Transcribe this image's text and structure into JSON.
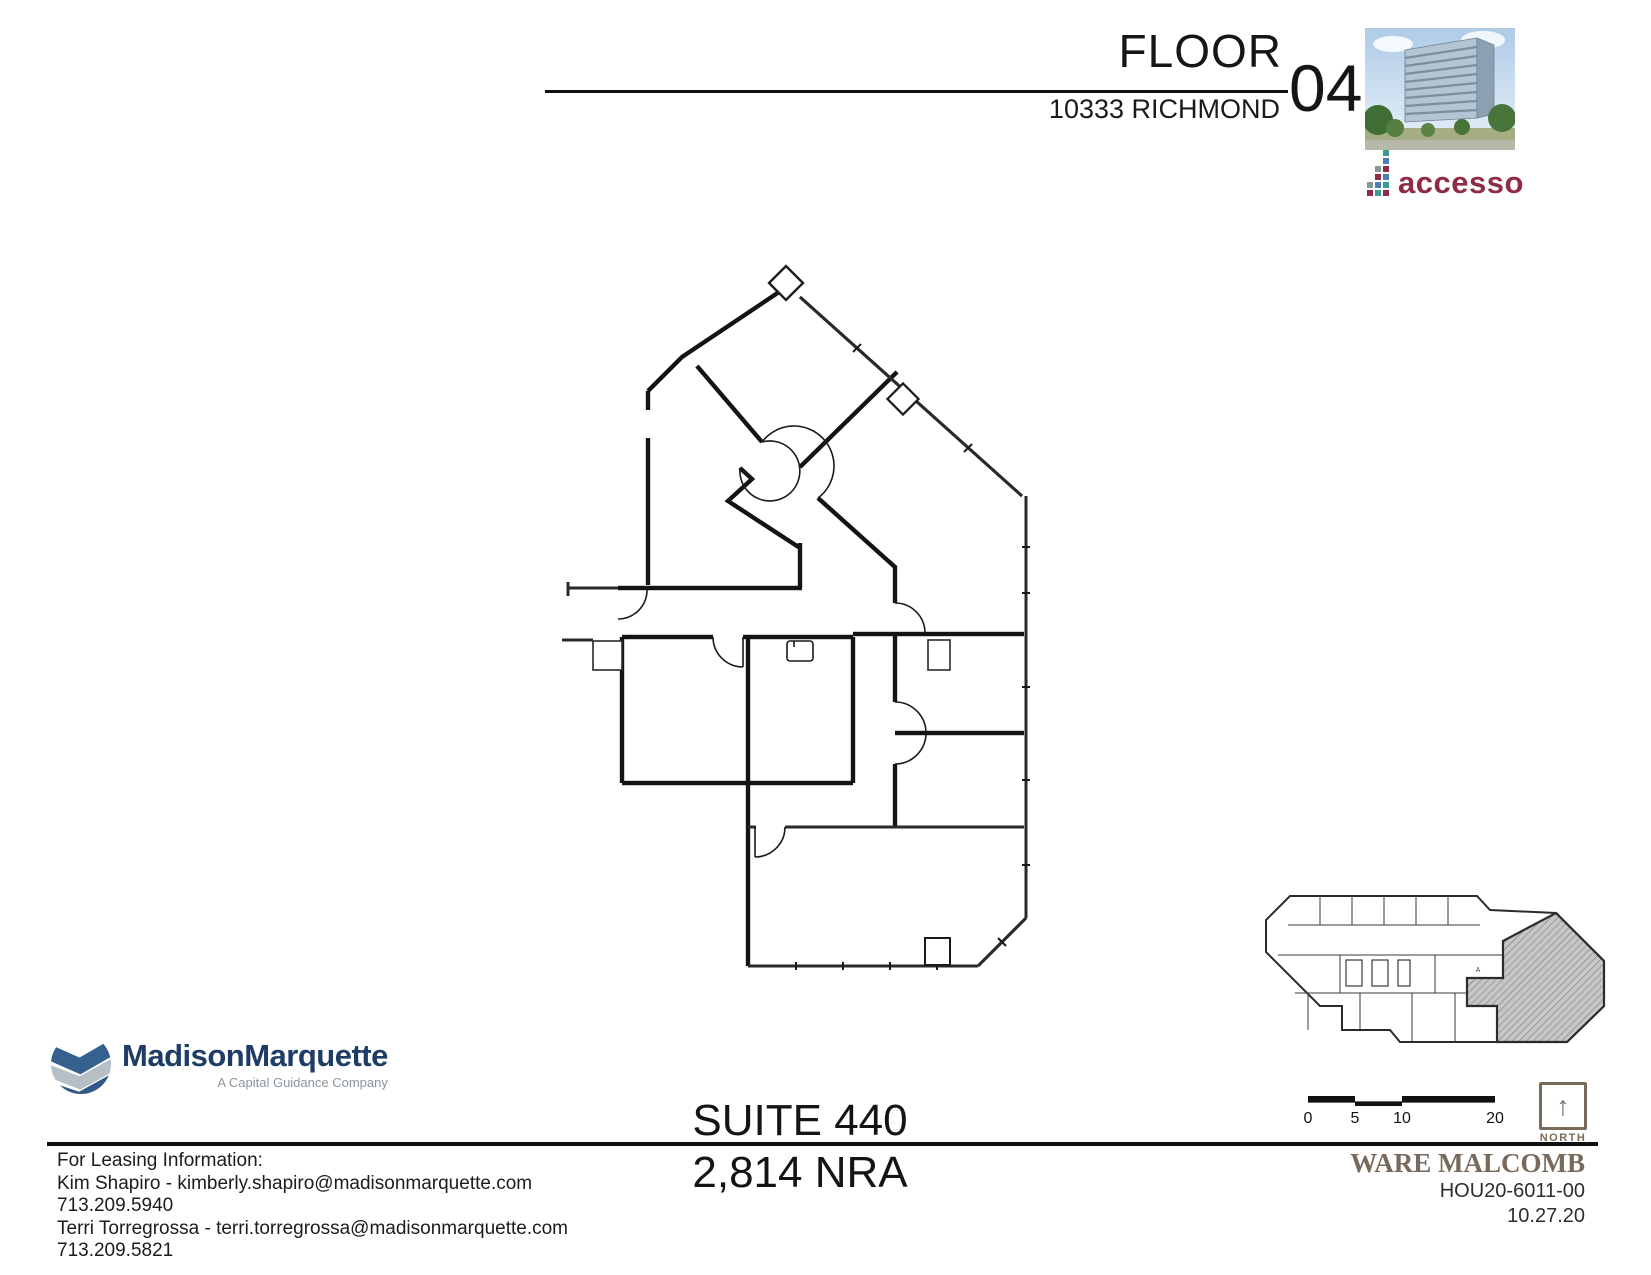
{
  "header": {
    "title": "FLOOR",
    "floor_number": "04",
    "address": "10333 RICHMOND"
  },
  "suite": {
    "name": "SUITE 440",
    "area": "2,814 NRA"
  },
  "leasing": {
    "heading": "For Leasing Information:",
    "lines": [
      "Kim Shapiro - kimberly.shapiro@madisonmarquette.com",
      "713.209.5940",
      "Terri Torregrossa - terri.torregrossa@madisonmarquette.com",
      "713.209.5821"
    ]
  },
  "branding": {
    "accesso": {
      "name": "accesso",
      "text_color": "#8f2b45"
    },
    "madison": {
      "name": "MadisonMarquette",
      "tagline": "A Capital Guidance Company",
      "navy": "#1d3c66"
    },
    "ware_malcomb": {
      "name": "WARE MALCOMB",
      "project_number": "HOU20-6011-00",
      "date": "10.27.20",
      "color": "#776a5c"
    }
  },
  "map": {
    "north_label": "NORTH",
    "north_arrow": "↑",
    "scale_labels": [
      "0",
      "5",
      "10",
      "20"
    ]
  },
  "keyplan": {
    "room_label": "A"
  },
  "icons": {
    "building_photo": "office-tower-photo",
    "madison_logo": "madison-marquette-globe-icon",
    "accesso_dots": "accesso-dot-matrix-icon",
    "north": "north-arrow-icon"
  },
  "colors": {
    "wall": "#141414",
    "accesso_red": "#8f2b45",
    "accesso_teal": "#3a9a96",
    "accesso_blue": "#4a7fae",
    "madison_navy": "#35618e",
    "ware_brown": "#7a6b59",
    "hatch_gray": "#c9c9c9"
  }
}
